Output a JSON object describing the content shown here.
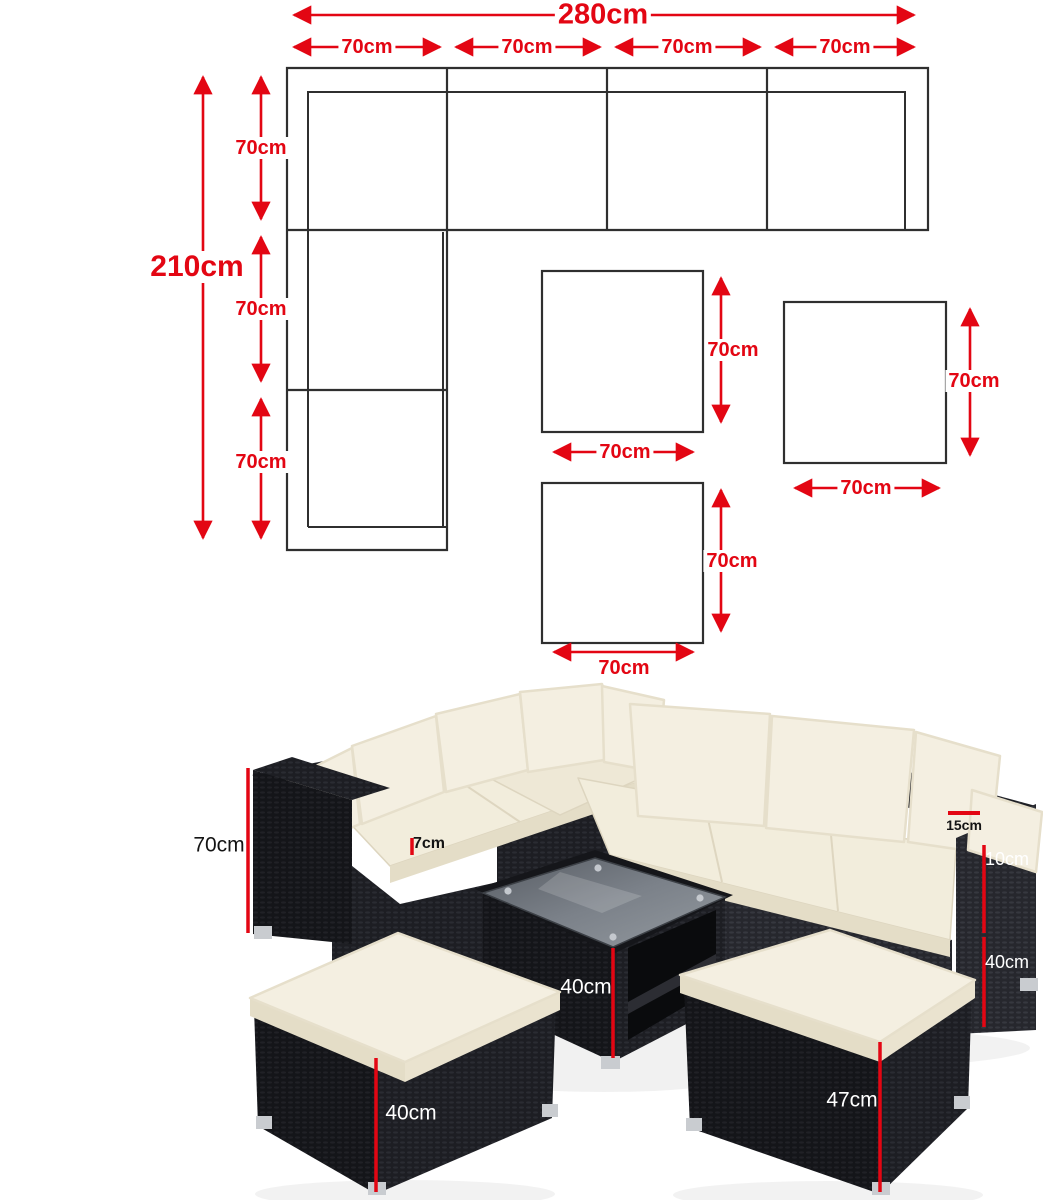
{
  "diagram": {
    "width_total": "280cm",
    "width_segments": [
      "70cm",
      "70cm",
      "70cm",
      "70cm"
    ],
    "height_total": "210cm",
    "height_segments": [
      "70cm",
      "70cm",
      "70cm"
    ],
    "square1": {
      "height_label": "70cm",
      "width_label": "70cm"
    },
    "square2": {
      "height_label": "70cm",
      "width_label": "70cm"
    },
    "square3": {
      "height_label": "70cm",
      "width_label": "70cm"
    }
  },
  "photo": {
    "sofa_height": "70cm",
    "seat_cushion_thickness": "7cm",
    "back_cushion_thickness": "15cm",
    "armrest_depth": "10cm",
    "seat_height": "40cm",
    "table_height": "40cm",
    "small_ottoman_height": "40cm",
    "large_ottoman_height": "47cm"
  },
  "colors": {
    "dimension_red": "#e30613",
    "diagram_line": "#2f2f2f",
    "rattan_black": "#1b1c20",
    "cushion_cream": "#f2edda"
  }
}
